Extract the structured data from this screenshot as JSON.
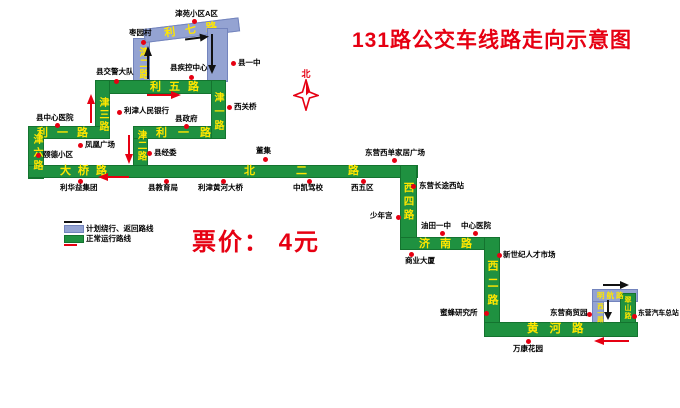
{
  "title": "131路公交车线路走向示意图",
  "fare_label": "票价： 4元",
  "compass_label": "北",
  "legend": {
    "detour_label": "计划绕行、返回路线",
    "normal_label": "正常运行路线"
  },
  "colors": {
    "route_normal": "#1f9140",
    "route_detour": "#94a3d2",
    "road_label": "#ffe600",
    "accent_red": "#e60012"
  },
  "roads": {
    "liwu": "利五路",
    "jinsan": "津三路",
    "liyi_west": "利一路",
    "jinliu": "津六路",
    "daqiao": "大桥路",
    "beier": "北二路",
    "jiner_south": "津二路",
    "liyi_east": "利一路",
    "jinyi": "津一路",
    "xisi": "西四路",
    "jinan": "济南路",
    "xier": "西二路",
    "huanghe": "黄河路",
    "cuishan": "翠山路",
    "jiner_north": "津二路",
    "liqi": "利七路",
    "minghang": "明航路",
    "xiyi": "西一路"
  },
  "stops": [
    {
      "name": "津苑小区A区"
    },
    {
      "name": "枣园村"
    },
    {
      "name": "县交警大队"
    },
    {
      "name": "县疾控中心"
    },
    {
      "name": "县一中"
    },
    {
      "name": "西关桥"
    },
    {
      "name": "利津人民银行"
    },
    {
      "name": "县政府"
    },
    {
      "name": "县中心医院"
    },
    {
      "name": "凤凰广场"
    },
    {
      "name": "颐德小区"
    },
    {
      "name": "县经委"
    },
    {
      "name": "利华益集团"
    },
    {
      "name": "县教育局"
    },
    {
      "name": "利津黄河大桥"
    },
    {
      "name": "董集"
    },
    {
      "name": "中凯驾校"
    },
    {
      "name": "西五区"
    },
    {
      "name": "东营西单家居广场"
    },
    {
      "name": "东营长途西站"
    },
    {
      "name": "少年宫"
    },
    {
      "name": "油田一中"
    },
    {
      "name": "中心医院"
    },
    {
      "name": "商业大厦"
    },
    {
      "name": "新世纪人才市场"
    },
    {
      "name": "蜜蜂研究所"
    },
    {
      "name": "东营商贸园"
    },
    {
      "name": "万康花园"
    },
    {
      "name": "东营汽车总站"
    }
  ]
}
